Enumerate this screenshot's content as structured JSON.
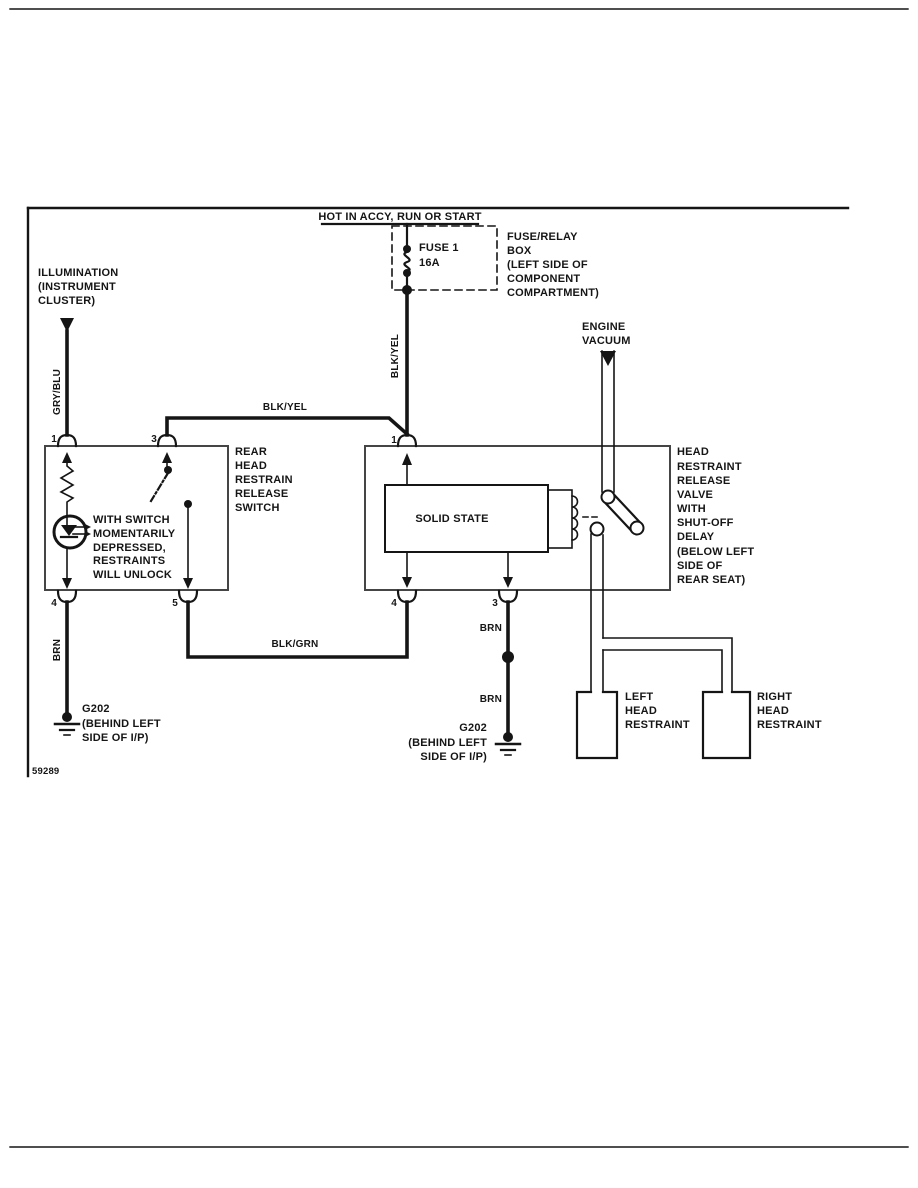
{
  "colors": {
    "ink": "#151515",
    "box_stroke": "#454545"
  },
  "figure_number": "59289",
  "power": {
    "label": "HOT IN ACCY, RUN OR START"
  },
  "fuse": {
    "name": "FUSE 1",
    "rating": "16A",
    "box_label": [
      "FUSE/RELAY",
      "BOX",
      "(LEFT SIDE OF",
      "COMPONENT",
      "COMPARTMENT)"
    ]
  },
  "illumination": {
    "lines": [
      "ILLUMINATION",
      "(INSTRUMENT",
      "CLUSTER)"
    ]
  },
  "engine_vacuum": {
    "lines": [
      "ENGINE",
      "VACUUM"
    ]
  },
  "wires": {
    "gry_blu": "GRY/BLU",
    "blk_yel_vert": "BLK/YEL",
    "blk_yel_horiz": "BLK/YEL",
    "blk_grn": "BLK/GRN",
    "brn_left": "BRN",
    "brn_mid_upper": "BRN",
    "brn_mid_lower": "BRN"
  },
  "switch_box": {
    "name_lines": [
      "REAR",
      "HEAD",
      "RESTRAIN",
      "RELEASE",
      "SWITCH"
    ],
    "note_lines": [
      "WITH SWITCH",
      "MOMENTARILY",
      "DEPRESSED,",
      "RESTRAINTS",
      "WILL UNLOCK"
    ],
    "pins": {
      "p1": "1",
      "p3": "3",
      "p4": "4",
      "p5": "5"
    }
  },
  "valve_box": {
    "solid_state": "SOLID STATE",
    "name_lines": [
      "HEAD",
      "RESTRAINT",
      "RELEASE",
      "VALVE",
      "WITH",
      "SHUT-OFF",
      "DELAY",
      "(BELOW LEFT",
      "SIDE OF",
      "REAR SEAT)"
    ],
    "pins": {
      "p1": "1",
      "p4": "4",
      "p3": "3"
    }
  },
  "grounds": {
    "left_lines": [
      "G202",
      "(BEHIND LEFT",
      "SIDE OF I/P)"
    ],
    "middle_lines": [
      "G202",
      "(BEHIND LEFT",
      "SIDE OF I/P)"
    ]
  },
  "restraints": {
    "left_lines": [
      "LEFT",
      "HEAD",
      "RESTRAINT"
    ],
    "right_lines": [
      "RIGHT",
      "HEAD",
      "RESTRAINT"
    ]
  }
}
